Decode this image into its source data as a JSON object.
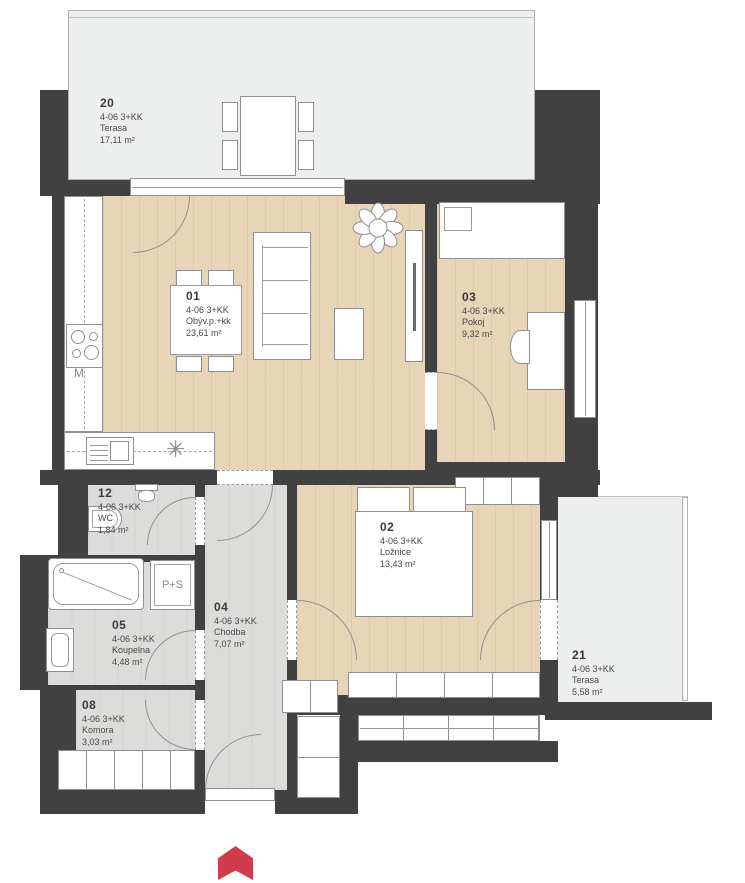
{
  "unit": {
    "code": "4-06 3+KK"
  },
  "rooms": {
    "r20": {
      "number": "20",
      "code": "4-06  3+KK",
      "name": "Terasa",
      "area": "17,11 m²"
    },
    "r01": {
      "number": "01",
      "code": "4-06  3+KK",
      "name": "Obýv.p.+kk",
      "area": "23,61 m²"
    },
    "r03": {
      "number": "03",
      "code": "4-06  3+KK",
      "name": "Pokoj",
      "area": "9,32 m²"
    },
    "r12": {
      "number": "12",
      "code": "4-06  3+KK",
      "name": "WC",
      "area": "1,84 m²"
    },
    "r02": {
      "number": "02",
      "code": "4-06  3+KK",
      "name": "Ložnice",
      "area": "13,43 m²"
    },
    "r04": {
      "number": "04",
      "code": "4-06  3+KK",
      "name": "Chodba",
      "area": "7,07 m²"
    },
    "r05": {
      "number": "05",
      "code": "4-06  3+KK",
      "name": "Koupelna",
      "area": "4,48 m²"
    },
    "r08": {
      "number": "08",
      "code": "4-06  3+KK",
      "name": "Komora",
      "area": "3,03 m²"
    },
    "r21": {
      "number": "21",
      "code": "4-06  3+KK",
      "name": "Terasa",
      "area": "5,58 m²"
    }
  },
  "fixtures": {
    "fridge_label": "M",
    "washer_dryer_label": "P+S",
    "appliance_symbol": "✳"
  },
  "icons": {
    "entrance_marker": "north-arrow-icon"
  },
  "colors": {
    "wall": "#414141",
    "wood_floor": "#e8d4b6",
    "tile_floor": "#dcdcda",
    "terrace_floor": "#edefee",
    "arrow_red": "#d23b4b"
  }
}
